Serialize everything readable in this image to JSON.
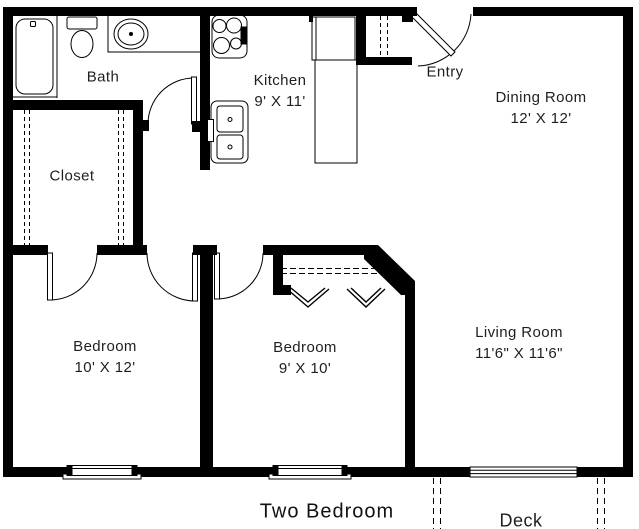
{
  "plan": {
    "title": "Two Bedroom",
    "rooms": {
      "bath": {
        "name": "Bath"
      },
      "closet": {
        "name": "Closet"
      },
      "kitchen": {
        "name": "Kitchen",
        "dims": "9' X 11'"
      },
      "entry": {
        "name": "Entry"
      },
      "dining_room": {
        "name": "Dining Room",
        "dims": "12' X 12'"
      },
      "bedroom_1": {
        "name": "Bedroom",
        "dims": "10' X 12'"
      },
      "bedroom_2": {
        "name": "Bedroom",
        "dims": "9' X 10'"
      },
      "living_room": {
        "name": "Living Room",
        "dims": "11'6\" X 11'6\""
      },
      "deck": {
        "name": "Deck"
      }
    },
    "fixtures": [
      "bathtub",
      "toilet",
      "bathroom-sink",
      "stove-oven",
      "kitchen-sink",
      "refrigerator",
      "kitchen-counter"
    ],
    "features": [
      "entry-door",
      "entry-closet",
      "walk-in-closet",
      "bifold-closet-doors",
      "bedroom-windows",
      "sliding-glass-door",
      "deck-outline"
    ],
    "colors": {
      "wall": "#000000",
      "background": "#ffffff",
      "text": "#1f1f1f"
    }
  }
}
